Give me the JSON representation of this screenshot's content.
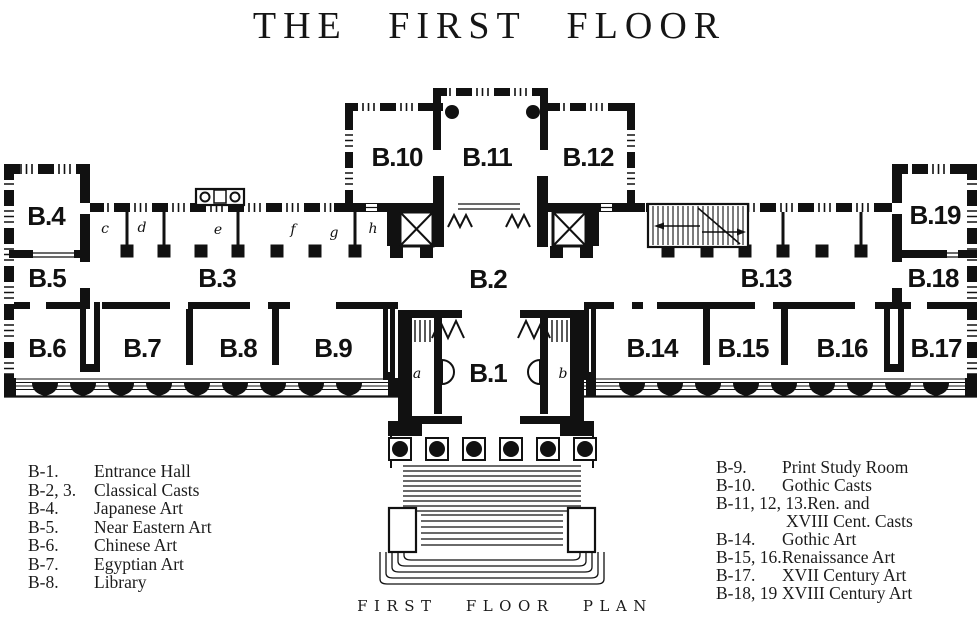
{
  "title": "THE FIRST FLOOR",
  "caption": "FIRST FLOOR PLAN",
  "colors": {
    "ink": "#111111",
    "paper": "#ffffff"
  },
  "rooms": {
    "b1": "B.1",
    "b2": "B.2",
    "b3": "B.3",
    "b4": "B.4",
    "b5": "B.5",
    "b6": "B.6",
    "b7": "B.7",
    "b8": "B.8",
    "b9": "B.9",
    "b10": "B.10",
    "b11": "B.11",
    "b12": "B.12",
    "b13": "B.13",
    "b14": "B.14",
    "b15": "B.15",
    "b16": "B.16",
    "b17": "B.17",
    "b18": "B.18",
    "b19": "B.19"
  },
  "marks": {
    "a": "a",
    "b": "b",
    "c": "c",
    "d": "d",
    "e": "e",
    "f": "f",
    "g": "g",
    "h": "h"
  },
  "legend_left": [
    {
      "code": "B-1.",
      "name": "Entrance Hall"
    },
    {
      "code": "B-2, 3.",
      "name": "Classical Casts"
    },
    {
      "code": "B-4.",
      "name": "Japanese Art"
    },
    {
      "code": "B-5.",
      "name": "Near Eastern Art"
    },
    {
      "code": "B-6.",
      "name": "Chinese Art"
    },
    {
      "code": "B-7.",
      "name": "Egyptian Art"
    },
    {
      "code": "B-8.",
      "name": "Library"
    }
  ],
  "legend_right": [
    {
      "code": "B-9.",
      "name": "Print Study Room"
    },
    {
      "code": "B-10.",
      "name": "Gothic Casts"
    },
    {
      "code": "B-11, 12, 13.",
      "name": "Ren. and",
      "name2": "XVIII Cent. Casts"
    },
    {
      "code": "B-14.",
      "name": "Gothic Art"
    },
    {
      "code": "B-15, 16.",
      "name": "Renaissance Art"
    },
    {
      "code": "B-17.",
      "name": "XVII Century Art"
    },
    {
      "code": "B-18, 19",
      "name": "XVIII Century Art"
    }
  ]
}
